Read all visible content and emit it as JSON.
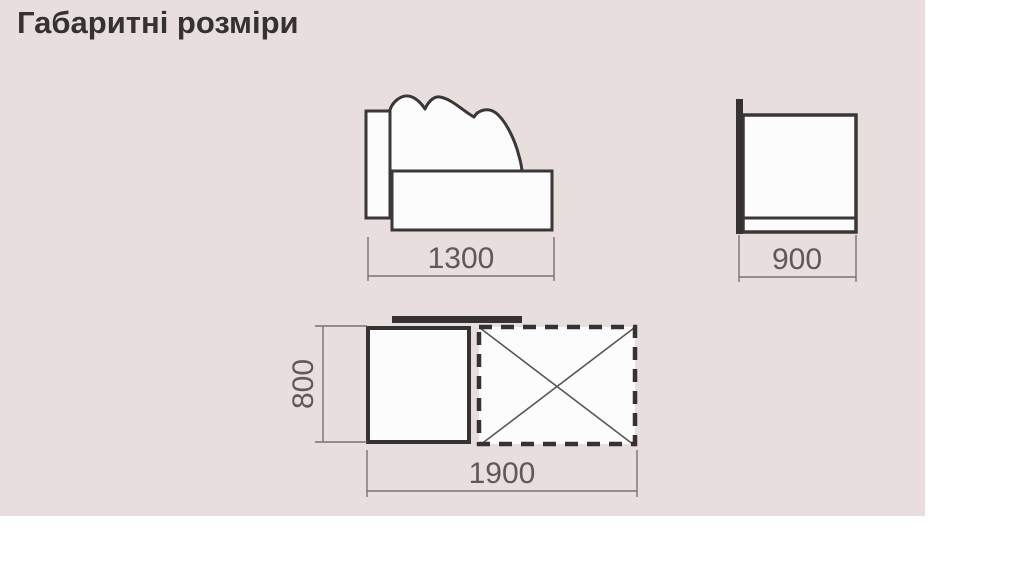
{
  "title": "Габаритні розміри",
  "dimensions": {
    "front_width": "1300",
    "side_depth": "900",
    "top_depth": "800",
    "top_length": "1900"
  },
  "colors": {
    "panel_background": "#e7dedd",
    "outline": "#3b3637",
    "solid_fill": "#363132",
    "shape_fill": "#fdfcfc",
    "dimension_line": "#7a7273",
    "dimension_text": "#5f5758",
    "title_text": "#363132"
  }
}
